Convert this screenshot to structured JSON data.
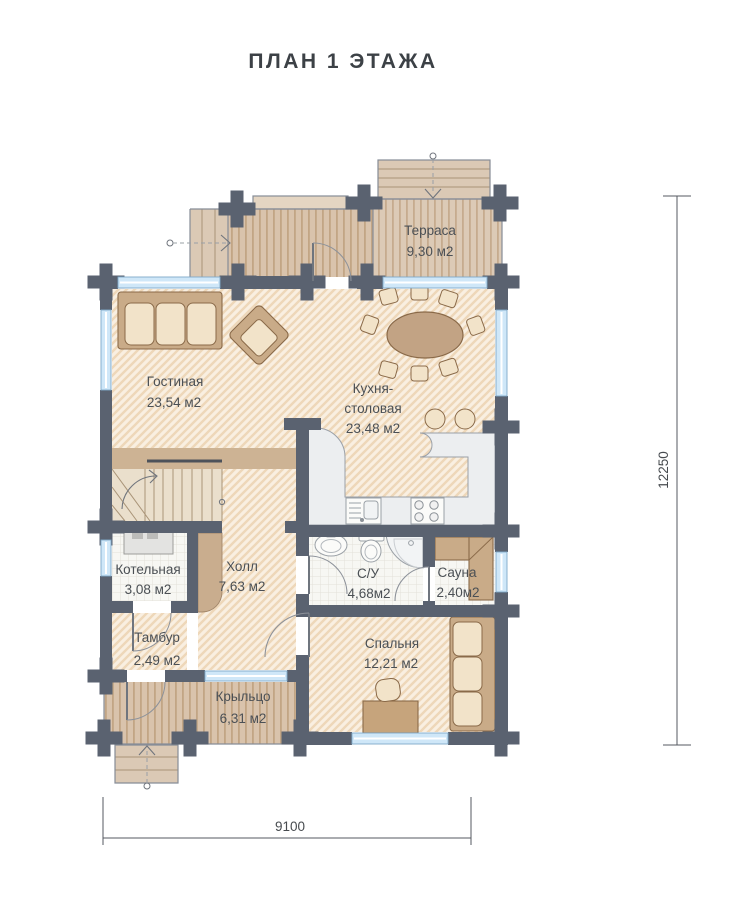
{
  "title": "ПЛАН  1  ЭТАЖА",
  "rooms": {
    "terrace": {
      "name": "Терраса",
      "area": "9,30 м2"
    },
    "living": {
      "name": "Гостиная",
      "area": "23,54 м2"
    },
    "kitchen": {
      "line1": "Кухня-",
      "line2": "столовая",
      "area": "23,48 м2"
    },
    "boiler": {
      "name": "Котельная",
      "area": "3,08 м2"
    },
    "hall": {
      "name": "Холл",
      "area": "7,63 м2"
    },
    "wc": {
      "name": "С/У",
      "area": "4,68м2"
    },
    "sauna": {
      "name": "Сауна",
      "area": "2,40м2"
    },
    "tambour": {
      "name": "Тамбур",
      "area": "2,49 м2"
    },
    "bedroom": {
      "name": "Спальня",
      "area": "12,21 м2"
    },
    "porch": {
      "name": "Крыльцо",
      "area": "6,31 м2"
    }
  },
  "dimensions": {
    "width_mm": "9100",
    "height_mm": "12250"
  },
  "colors": {
    "wall": "#5a6270",
    "floor_hatch_bg": "#f9efe1",
    "floor_hatch_line": "#eed7b9",
    "deck_bg": "#d9c3ac",
    "deck_line": "#c2a585",
    "step_bg": "#dbc9b5",
    "window_glass": "#cfe7f8",
    "tile_bg": "#f7f7f3",
    "furniture": "#c9ab88",
    "cushion": "#f2e3c9",
    "counter": "#eceef0",
    "label_text": "#4b5055"
  }
}
